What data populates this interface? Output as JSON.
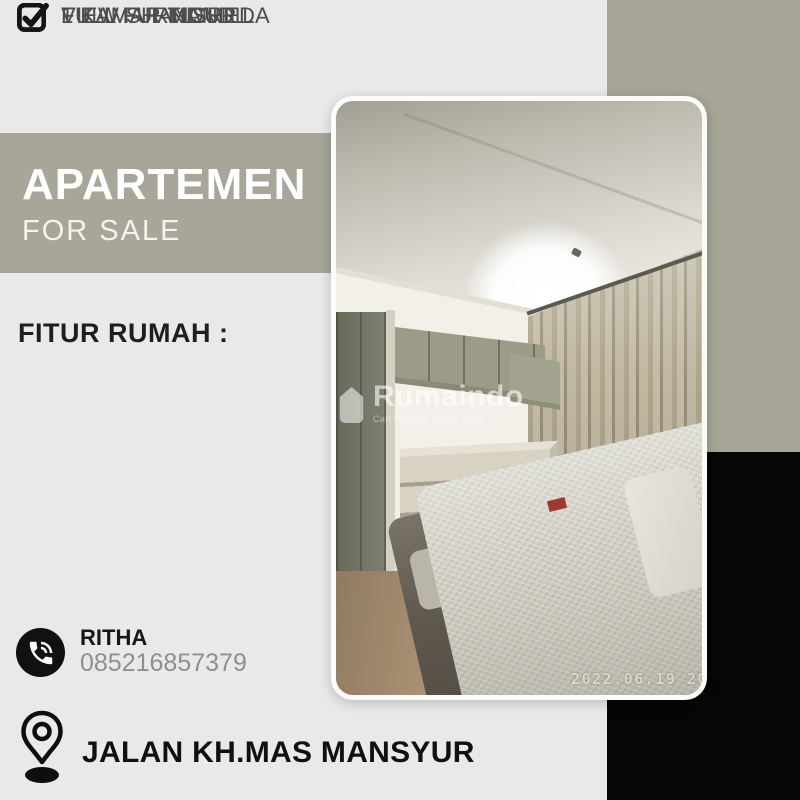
{
  "colors": {
    "background": "#e9e9e9",
    "accent_sage": "#a6a597",
    "panel_black": "#060606",
    "title_white": "#ffffff",
    "body_gray": "#4d4d4d",
    "phone_gray": "#8f8f8f"
  },
  "banner": {
    "title": "APARTEMEN",
    "subtitle": "FOR SALE"
  },
  "features": {
    "heading": "FITUR RUMAH :",
    "items": [
      "FULL FURNISHED",
      "1 KAMAR TIDUR",
      "1 KAMAR MANDI",
      "VIEW SHANGRILLA"
    ]
  },
  "contact": {
    "name": "RITHA",
    "phone": "085216857379"
  },
  "address": {
    "street": "JALAN KH.MAS MANSYUR"
  },
  "photo": {
    "watermark_brand": "Rumaindo",
    "watermark_tagline": "Cari Properti Tanpa Ribet",
    "timestamp": "2022.06.19 20"
  }
}
